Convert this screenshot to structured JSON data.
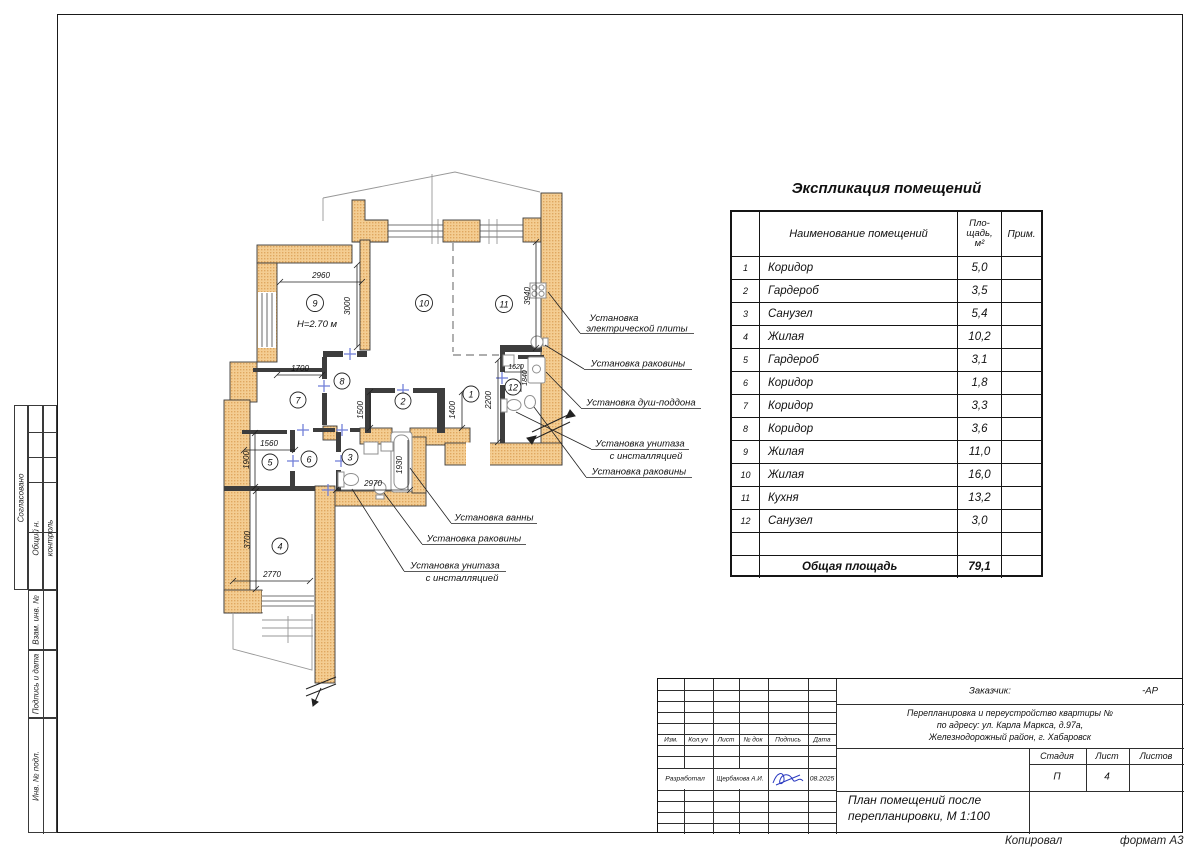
{
  "sidebar": {
    "agreed": "Согласовано",
    "general_label": "Общий н.",
    "control_label": "контроль",
    "box_replace": "Взам. инв. №",
    "box_sign": "Подпись и дата",
    "box_inv": "Инв. № подл."
  },
  "table": {
    "title": "Экспликация помещений",
    "headers": {
      "name": "Наименование помещений",
      "area": [
        "Пло-",
        "щадь,",
        "м²"
      ],
      "note": "Прим."
    },
    "rows": [
      {
        "num": "1",
        "name": "Коридор",
        "area": "5,0",
        "note": ""
      },
      {
        "num": "2",
        "name": "Гардероб",
        "area": "3,5",
        "note": ""
      },
      {
        "num": "3",
        "name": "Санузел",
        "area": "5,4",
        "note": ""
      },
      {
        "num": "4",
        "name": "Жилая",
        "area": "10,2",
        "note": ""
      },
      {
        "num": "5",
        "name": "Гардероб",
        "area": "3,1",
        "note": ""
      },
      {
        "num": "6",
        "name": "Коридор",
        "area": "1,8",
        "note": ""
      },
      {
        "num": "7",
        "name": "Коридор",
        "area": "3,3",
        "note": ""
      },
      {
        "num": "8",
        "name": "Коридор",
        "area": "3,6",
        "note": ""
      },
      {
        "num": "9",
        "name": "Жилая",
        "area": "11,0",
        "note": ""
      },
      {
        "num": "10",
        "name": "Жилая",
        "area": "16,0",
        "note": ""
      },
      {
        "num": "11",
        "name": "Кухня",
        "area": "13,2",
        "note": ""
      },
      {
        "num": "12",
        "name": "Санузел",
        "area": "3,0",
        "note": ""
      }
    ],
    "total_label": "Общая площадь",
    "total_area": "79,1"
  },
  "plan": {
    "height_label": "Н=2.70 м",
    "room_numbers": [
      "1",
      "2",
      "3",
      "4",
      "5",
      "6",
      "7",
      "8",
      "9",
      "10",
      "11",
      "12"
    ],
    "dims": {
      "d2960": "2960",
      "d3000": "3000",
      "d1700": "1700",
      "d1500": "1500",
      "d1400": "1400",
      "d2200": "2200",
      "d1620": "1620",
      "d1840": "1840",
      "d3940": "3940",
      "d1560": "1560",
      "d1900": "1900",
      "d2970": "2970",
      "d1930": "1930",
      "d3700": "3700",
      "d2770": "2770"
    },
    "callouts": {
      "stove1": "Установка",
      "stove2": "электрической плиты",
      "sink_kitchen": "Установка раковины",
      "shower": "Установка душ-поддона",
      "wc12_1": "Установка унитаза",
      "wc12_2": "с инсталляцией",
      "sink12": "Установка раковины",
      "bath": "Установка ванны",
      "sink3": "Установка раковины",
      "wc3_1": "Установка унитаза",
      "wc3_2": "с инсталляцией"
    }
  },
  "title_block": {
    "customer_label": "Заказчик:",
    "code": "-АР",
    "address_lines": [
      "Перепланировка и переустройство квартиры №",
      "по адресу: ул. Карла Маркса, д.97а,",
      "Железнодорожный район, г. Хабаровск"
    ],
    "col_headers": [
      "Изм.",
      "Кол.уч",
      "Лист",
      "№ док",
      "Подпись",
      "Дата"
    ],
    "developed_label": "Разработал",
    "developer_name": "Щербакова А.И.",
    "date": "08.2025",
    "stage_label": "Стадия",
    "sheet_label": "Лист",
    "sheets_label": "Листов",
    "stage": "П",
    "sheet_num": "4",
    "doc_title_lines": [
      "План помещений после",
      "перепланировки, М 1:100"
    ]
  },
  "footer": {
    "copied": "Копировал",
    "format": "формат  А3"
  }
}
